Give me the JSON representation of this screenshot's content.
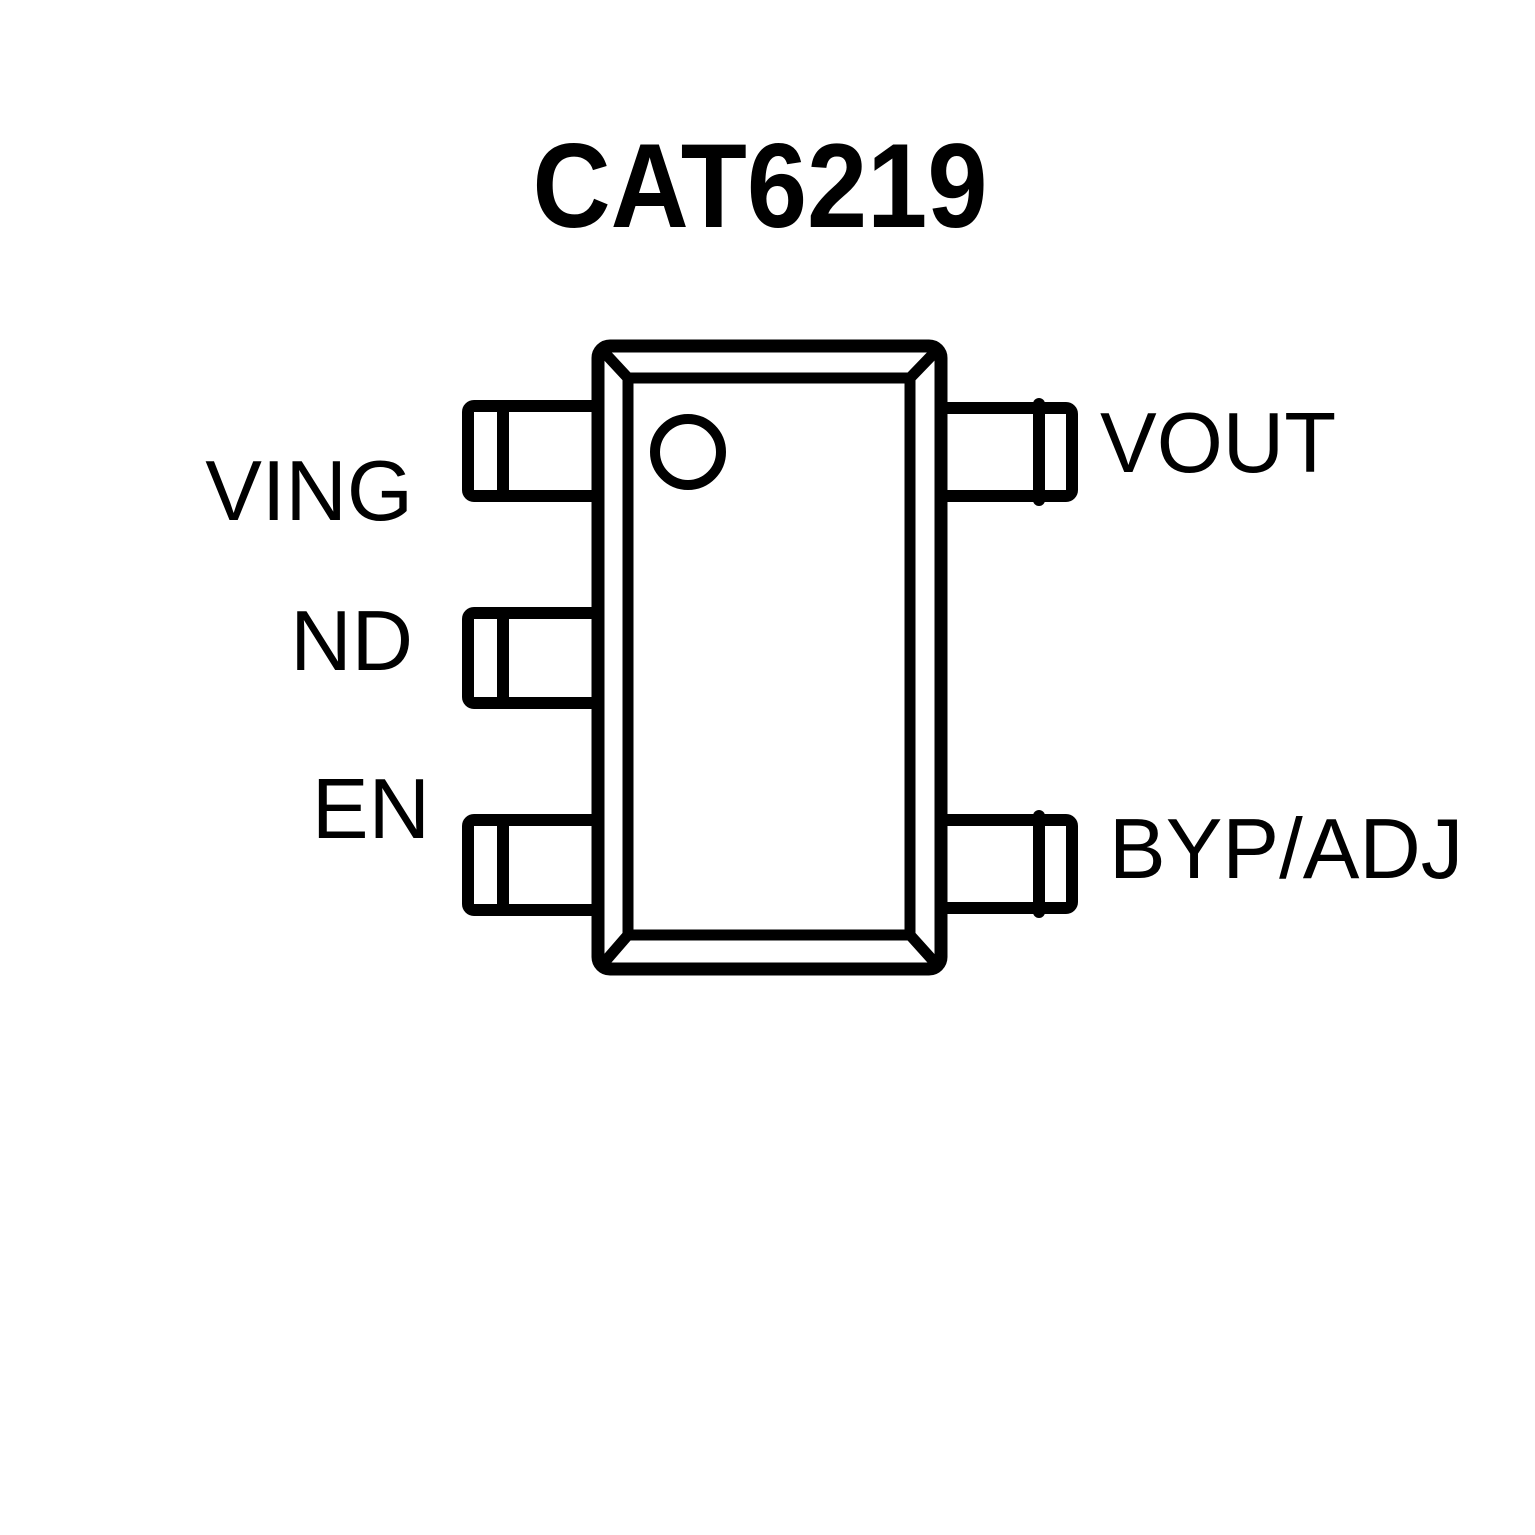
{
  "title": "CAT6219",
  "colors": {
    "line": "#000000",
    "background": "#ffffff"
  },
  "chip": {
    "package_marker": "pin1-indicator-dot",
    "left_pins": [
      {
        "label": "VING"
      },
      {
        "label": "ND"
      },
      {
        "label": "EN"
      }
    ],
    "right_pins": [
      {
        "label": "VOUT"
      },
      {
        "label": "BYP/ADJ"
      }
    ]
  }
}
